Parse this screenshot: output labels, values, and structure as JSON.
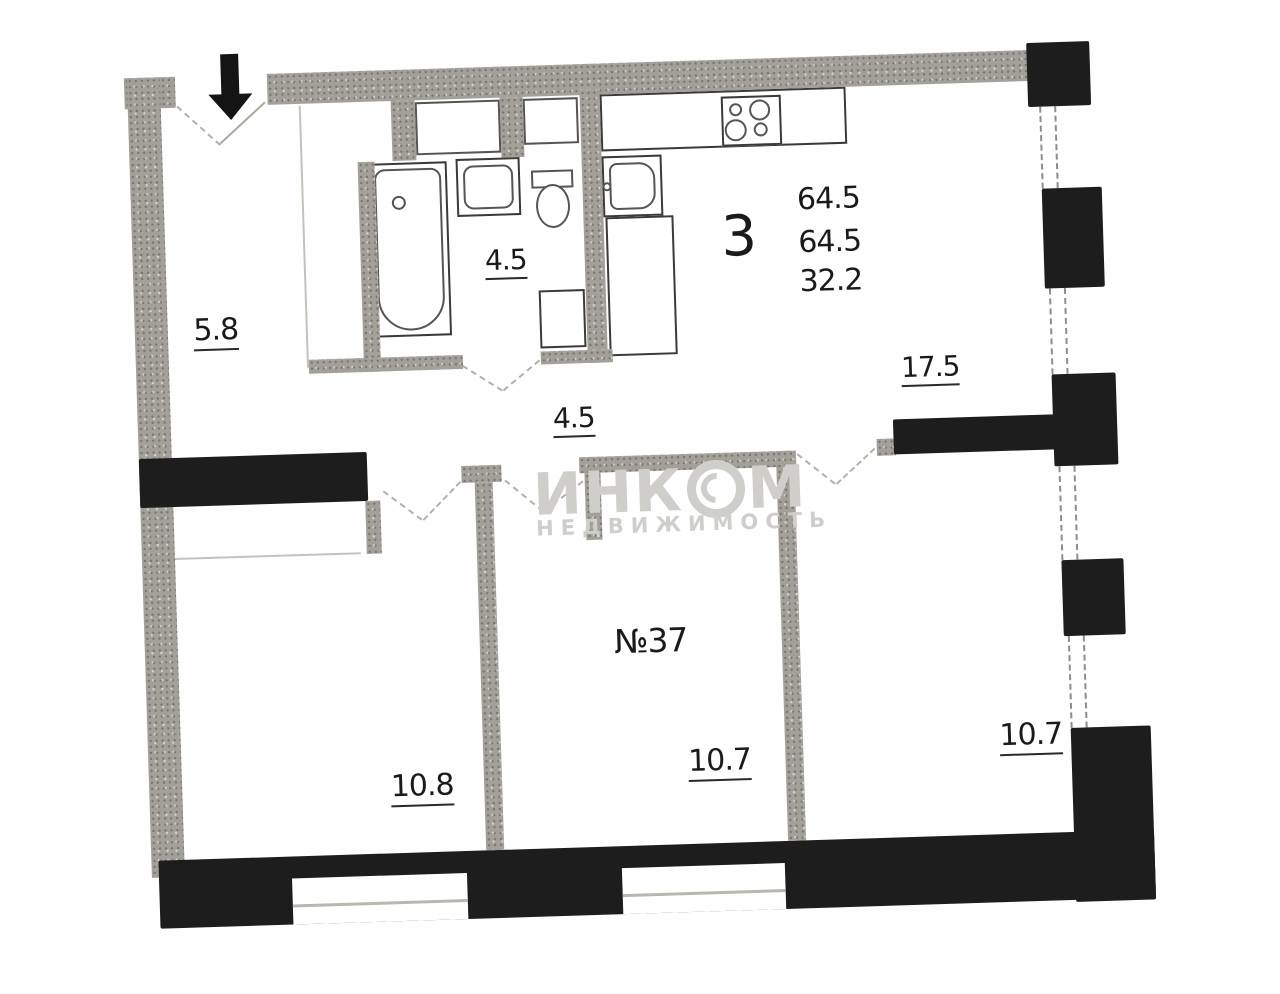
{
  "plan": {
    "apartment": {
      "rooms_count": "3",
      "total_area": "64.5",
      "living_plus_total": "64.5",
      "living_area": "32.2"
    },
    "unit_number": "№37",
    "rooms": {
      "hallway": "5.8",
      "bathroom": "4.5",
      "corridor": "4.5",
      "living_room": "17.5",
      "bedroom_left": "10.8",
      "bedroom_middle": "10.7",
      "bedroom_right": "10.7"
    },
    "watermark": {
      "brand": "ИНКОМ",
      "brand_left": "ИНК",
      "brand_right": "М",
      "subtitle": "НЕДВИЖИМОСТЬ"
    },
    "colors": {
      "wall_dark": "#1d1d1d",
      "wall_gray": "#a3a09a",
      "background": "#fefefe",
      "label_text": "#1a1a1a",
      "watermark_gray": "#cfcecb"
    }
  }
}
